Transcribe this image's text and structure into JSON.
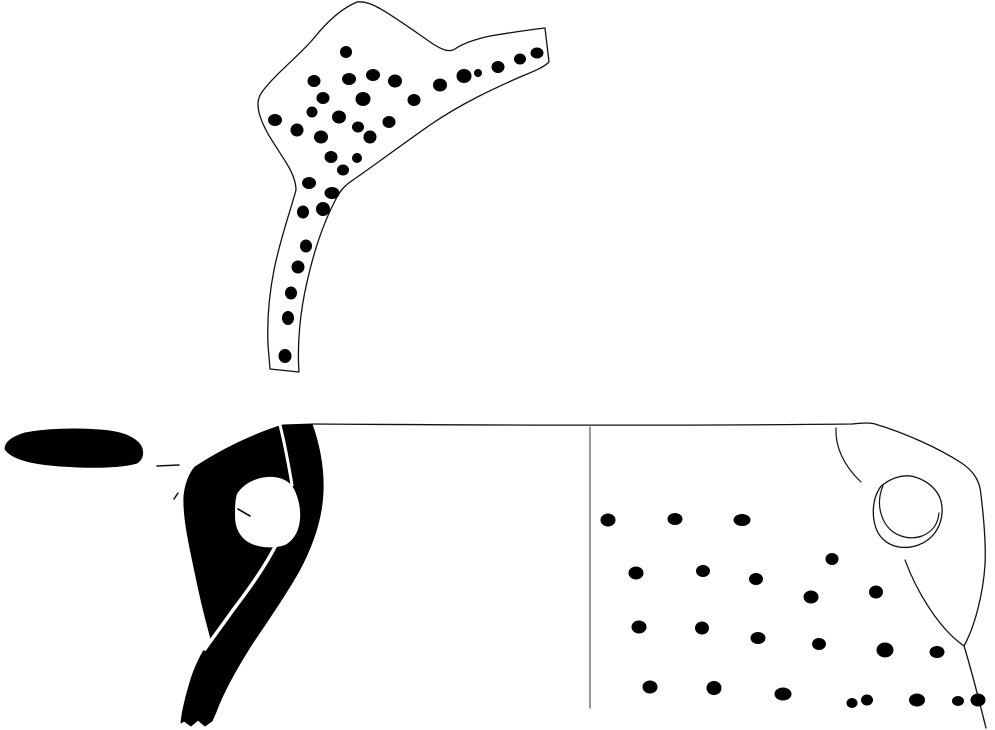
{
  "meta": {
    "title": "archaeological-pottery-drawing",
    "width": 995,
    "height": 730,
    "background": "#ffffff",
    "ink": "#111111",
    "fill_black": "#000000",
    "section_line_color": "#555555"
  },
  "figure": {
    "elements": [
      {
        "name": "top-sherd-outline",
        "type": "path",
        "d": "M357,2 C345,7 330,18 314,38 C300,55 275,74 262,92 C257,99 257,106 260,116 C265,132 276,146 287,164 C293,174 296,182 296,190 C290,212 280,240 274,270 C269,295 267,320 268,345 L270,369 L299,372 C297,345 300,312 307,282 C313,255 323,223 337,197 C342,188 347,184 353,180 C372,167 400,146 430,125 C462,103 495,88 520,77 C532,72 543,68 549,62 L545,28 C528,30 508,33 490,36 C472,40 462,44 455,49 C449,53 441,49 433,44 C417,33 395,17 379,8 C372,4 364,1 357,2 Z",
        "fill": "#ffffff",
        "stroke": "#111111",
        "sw": 1.3
      },
      {
        "name": "top-sherd-stipple",
        "type": "dots",
        "fill": "#000000",
        "points": [
          [
            346,
            52,
            6,
            6
          ],
          [
            314,
            81,
            6.5,
            6
          ],
          [
            349,
            79,
            7,
            6
          ],
          [
            373,
            75,
            7,
            6
          ],
          [
            395,
            81,
            7,
            6.5
          ],
          [
            440,
            85,
            7,
            6.5
          ],
          [
            464,
            76,
            7.5,
            7
          ],
          [
            478,
            73,
            4,
            4
          ],
          [
            498,
            67,
            6.5,
            6
          ],
          [
            520,
            59,
            6,
            5.5
          ],
          [
            537,
            53,
            6.5,
            5.5
          ],
          [
            323,
            98,
            6.5,
            6
          ],
          [
            363,
            99,
            7.5,
            7
          ],
          [
            414,
            100,
            6.5,
            6
          ],
          [
            312,
            112,
            5.5,
            5.5
          ],
          [
            339,
            117,
            7,
            6.5
          ],
          [
            389,
            122,
            6.5,
            6
          ],
          [
            275,
            120,
            7,
            6
          ],
          [
            297,
            130,
            6.5,
            6.5
          ],
          [
            321,
            137,
            7,
            6.5
          ],
          [
            358,
            127,
            6,
            5.5
          ],
          [
            370,
            137,
            6.5,
            6.5
          ],
          [
            331,
            157,
            6.5,
            6
          ],
          [
            357,
            158,
            5,
            5
          ],
          [
            343,
            170,
            6,
            5.5
          ],
          [
            309,
            183,
            7,
            6
          ],
          [
            332,
            193,
            7.5,
            6
          ],
          [
            303,
            212,
            6,
            6.5
          ],
          [
            323,
            209,
            7,
            7
          ],
          [
            306,
            246,
            6,
            6.5
          ],
          [
            298,
            267,
            6.5,
            6.5
          ],
          [
            291,
            293,
            6,
            6.5
          ],
          [
            288,
            318,
            6,
            7
          ],
          [
            285,
            356,
            6.5,
            7
          ]
        ]
      },
      {
        "name": "rim-section-blob",
        "type": "path",
        "d": "M5,449 C5,442 12,437 25,433 C45,429 75,428 100,430 C118,431 135,436 141,446 C144,452 143,459 137,463 C120,468 90,468 60,466 C35,464 12,460 5,449 Z",
        "fill": "#000000",
        "stroke": "#000000",
        "sw": 1
      },
      {
        "name": "leader-dash",
        "type": "line",
        "x1": 157,
        "y1": 466,
        "x2": 179,
        "y2": 465,
        "stroke": "#111111",
        "sw": 1.5
      },
      {
        "name": "left-tick-mark",
        "type": "line",
        "x1": 174,
        "y1": 499,
        "x2": 178,
        "y2": 493,
        "stroke": "#111111",
        "sw": 1.5
      },
      {
        "name": "profile-body-section",
        "type": "path",
        "d": "M195,467 C218,452 250,435 283,425 L312,424 C319,444 324,468 323,492 C322,518 313,545 299,571 C285,596 268,620 252,644 C238,666 224,690 216,712 L212,721 L205,726 L198,720 L191,726 L184,721 L181,723 C182,712 186,695 192,676 C198,659 205,648 211,639 C206,621 200,597 195,572 C189,544 183,517 184,496 C185,485 189,474 195,467 Z",
        "fill": "#000000",
        "stroke": "#000000",
        "sw": 1
      },
      {
        "name": "profile-split-line-top",
        "type": "path",
        "d": "M280,425 C284,441 288,461 292,485",
        "fill": "none",
        "stroke": "#ffffff",
        "sw": 3
      },
      {
        "name": "handle-opening-hole",
        "type": "path",
        "d": "M237,494 C243,484 255,478 267,477 C280,476 290,481 294,489 C298,497 301,508 300,519 C299,531 294,540 285,545 C274,549 258,548 248,542 C239,536 235,527 235,516 C235,508 235,500 237,494 Z",
        "fill": "#ffffff",
        "stroke": "none",
        "sw": 0
      },
      {
        "name": "profile-split-line-diagonal",
        "type": "path",
        "d": "M277,543 C266,565 250,588 233,610 C224,623 214,636 205,649",
        "fill": "none",
        "stroke": "#ffffff",
        "sw": 3.5
      },
      {
        "name": "handle-opening-tick",
        "type": "line",
        "x1": 238,
        "y1": 509,
        "x2": 250,
        "y2": 516,
        "stroke": "#111111",
        "sw": 1.6
      },
      {
        "name": "face-rim-and-right-contour",
        "type": "path",
        "d": "M312,424 C460,425 680,426 852,424 C862,423 871,422 878,425 C905,433 938,448 960,462 C974,471 980,481 981,495 C984,520 986,545 985,565 C983,594 975,626 964,646 C971,668 978,696 986,728",
        "fill": "none",
        "stroke": "#111111",
        "sw": 1.3
      },
      {
        "name": "section-divider-line",
        "type": "line",
        "x1": 590,
        "y1": 427,
        "x2": 590,
        "y2": 708,
        "stroke": "#555555",
        "sw": 1.2
      },
      {
        "name": "shoulder-arc",
        "type": "path",
        "d": "M836,428 C835,447 844,466 861,482",
        "fill": "none",
        "stroke": "#111111",
        "sw": 1.2
      },
      {
        "name": "handle-scar-outer",
        "type": "path",
        "d": "M884,484 C893,477 905,474 915,477 C928,481 938,490 941,501 C944,513 941,525 934,534 C926,544 912,549 899,547 C887,545 878,537 875,525 C872,514 873,500 878,491 C880,487 882,485 884,484 Z",
        "fill": "none",
        "stroke": "#111111",
        "sw": 1.3
      },
      {
        "name": "handle-scar-inner",
        "type": "path",
        "d": "M883,486 C878,497 878,511 885,523 C892,535 908,541 922,536 C932,532 938,524 939,513",
        "fill": "none",
        "stroke": "#111111",
        "sw": 1.2
      },
      {
        "name": "handle-attachment-curve",
        "type": "path",
        "d": "M905,560 C916,590 938,628 964,646",
        "fill": "none",
        "stroke": "#111111",
        "sw": 1.2
      },
      {
        "name": "face-stipple",
        "type": "dots",
        "fill": "#000000",
        "points": [
          [
            608,
            520,
            7.5,
            6.5
          ],
          [
            675,
            519,
            7.5,
            6
          ],
          [
            742,
            520,
            8.5,
            6
          ],
          [
            832,
            559,
            6.5,
            6
          ],
          [
            636,
            573,
            7.5,
            6.5
          ],
          [
            703,
            571,
            7,
            6
          ],
          [
            756,
            579,
            7,
            6
          ],
          [
            876,
            592,
            7,
            6.5
          ],
          [
            811,
            597,
            7.5,
            6.5
          ],
          [
            639,
            627,
            7.5,
            6.5
          ],
          [
            702,
            628,
            7,
            6.5
          ],
          [
            758,
            638,
            7.5,
            6
          ],
          [
            819,
            644,
            7,
            6
          ],
          [
            885,
            650,
            8.5,
            7.5
          ],
          [
            937,
            652,
            7.5,
            6
          ],
          [
            650,
            687,
            7.5,
            6.5
          ],
          [
            714,
            688,
            7.5,
            7
          ],
          [
            783,
            694,
            8.5,
            6.5
          ],
          [
            852,
            703,
            5.5,
            5
          ],
          [
            867,
            700,
            6,
            5.5
          ],
          [
            917,
            700,
            8,
            6.5
          ],
          [
            958,
            701,
            6,
            5
          ],
          [
            978,
            700,
            7.5,
            6.5
          ]
        ]
      }
    ]
  }
}
